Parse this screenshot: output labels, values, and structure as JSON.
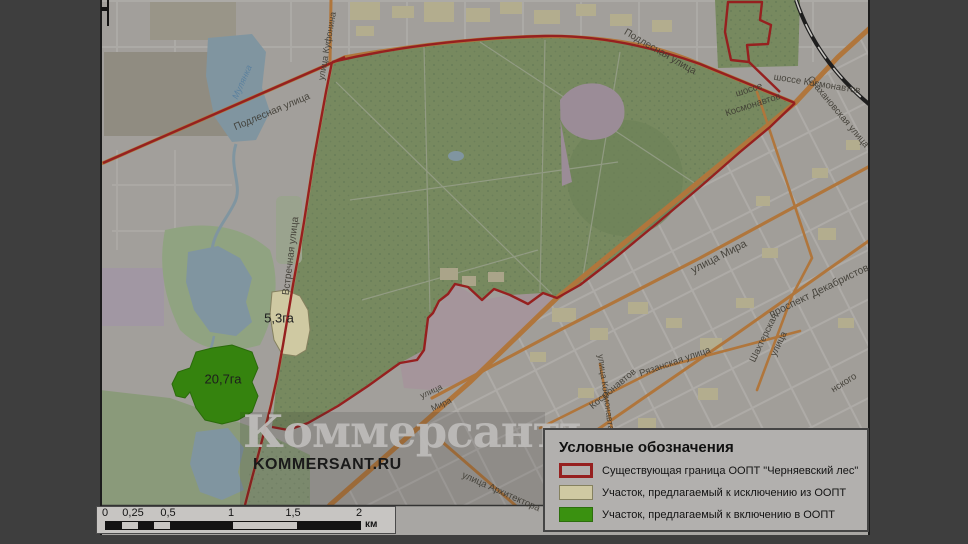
{
  "watermark": {
    "logo": "Коммерсантъ",
    "site": "KOMMERSANT.RU"
  },
  "legend": {
    "title": "Условные обозначения",
    "items": [
      {
        "label": "Существующая граница ООПТ \"Черняевский лес\"",
        "swatch": "outline",
        "color": "#96201f"
      },
      {
        "label": "Участок, предлагаемый к исключению из ООПТ",
        "swatch": "fill",
        "color": "#cfc9a2"
      },
      {
        "label": "Участок, предлагаемый к включению в ООПТ",
        "swatch": "fill",
        "color": "#3a9110"
      }
    ]
  },
  "scalebar": {
    "ticks": [
      "0",
      "0,25",
      "0,5",
      "1",
      "1,5",
      "2"
    ],
    "unit": "км"
  },
  "parcels": {
    "exclusion_area": "5,3га",
    "inclusion_area": "20,7га"
  },
  "streets": {
    "podlesnaya": "Подлесная улица",
    "kufonina": "улица Куфонина",
    "vstrechnaya": "Встречная улица",
    "mulyanka": "Мулянка",
    "shosse_word": "шоссе",
    "kosmonavtov_word": "Космонавтов",
    "shosse_kosmonavtov": "шоссе Космонавтов",
    "stakhanovskaya": "Стахановская улица",
    "mira": "улица Мира",
    "ulitsa_word": "улица",
    "mira_word": "Мира",
    "dekabristov": "проспект Декабристов",
    "shakhterskaya_word": "Шахтерская",
    "ryazanskaya": "Рязанская улица",
    "kosmonavta_leonova": "улица Космонавта Ле",
    "arkhitektora": "улица Архитектора",
    "nskogo_fragment": "нского"
  },
  "colors": {
    "boundary_red": "#96201f",
    "exclusion_yellow": "#cfc9a2",
    "inclusion_green": "#3a9110",
    "forest_green": "#77895f",
    "water_blue": "#8095a0",
    "major_road_orange": "#b0763c",
    "city_gray": "#a29f9b",
    "frame_dark": "#3e3e3e"
  }
}
